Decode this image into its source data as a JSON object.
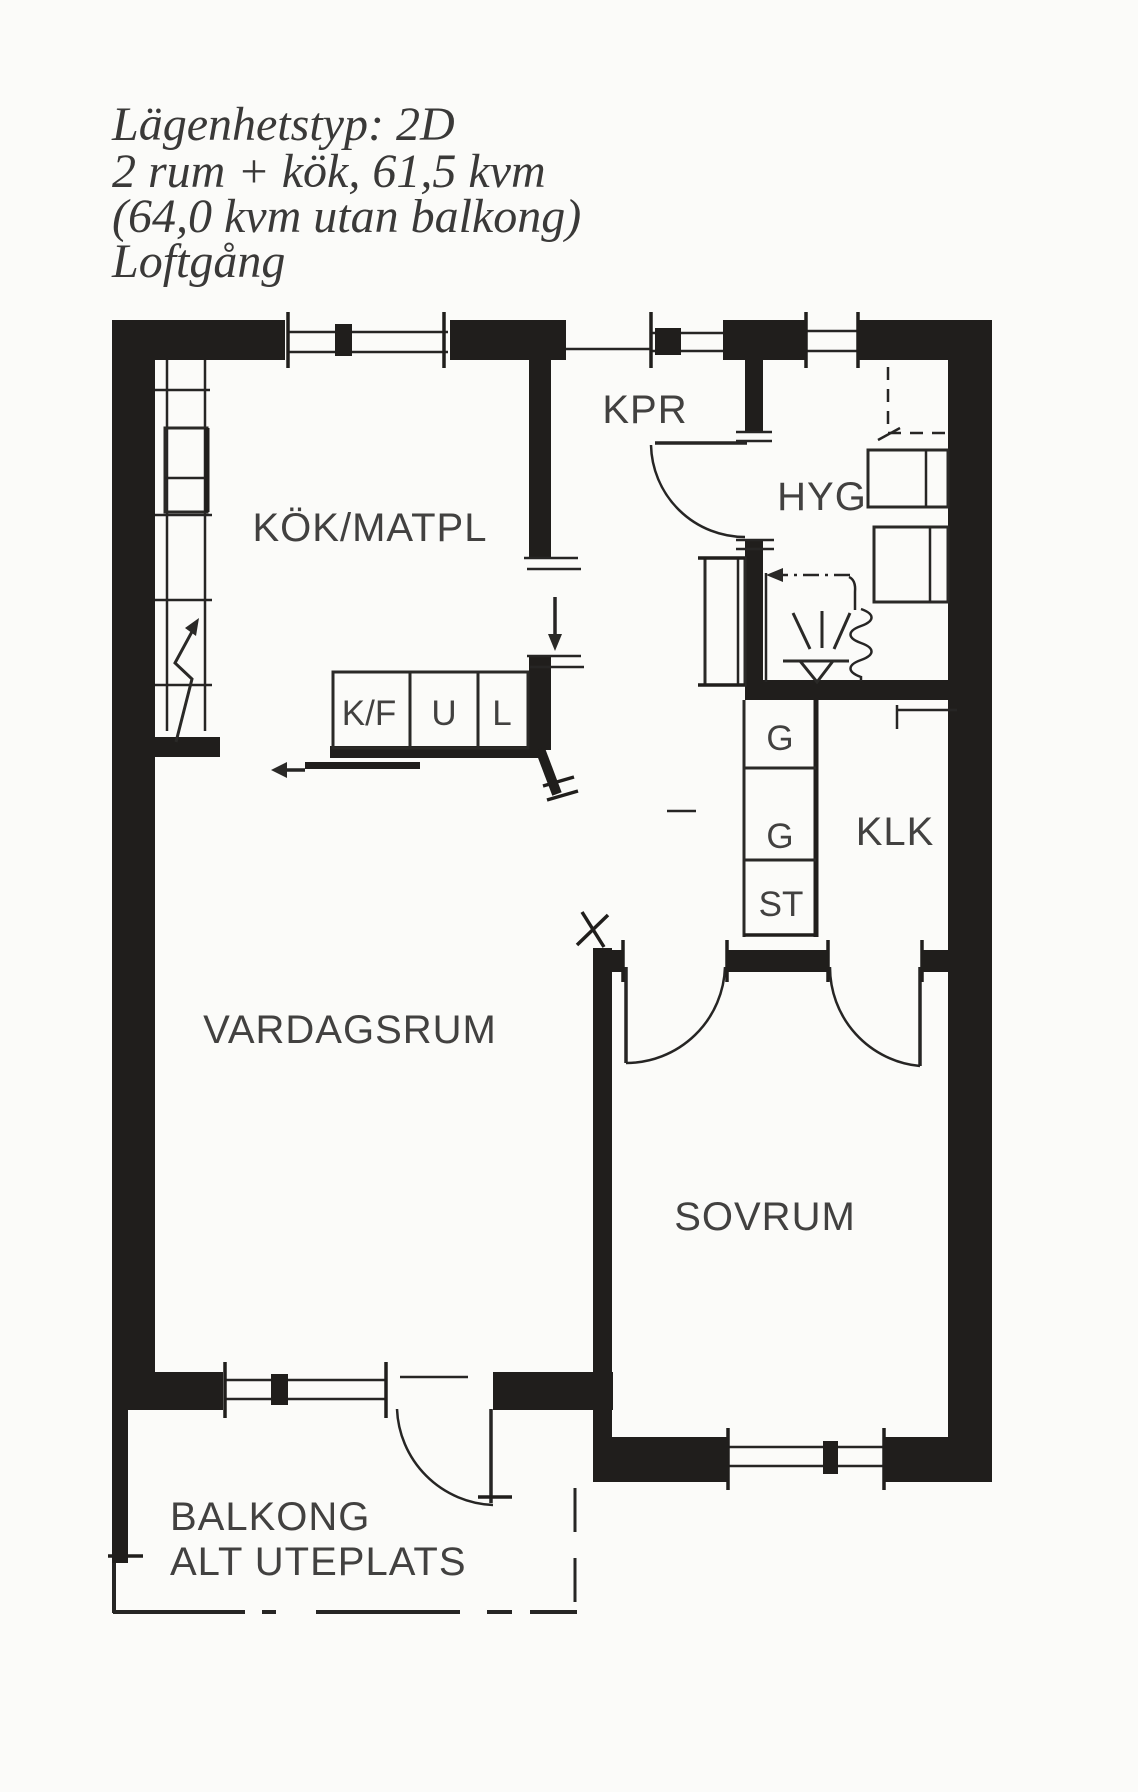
{
  "header": {
    "lines": [
      "Lägenhetstyp: 2D",
      "2 rum + kök, 61,5 kvm",
      "(64,0 kvm utan balkong)",
      "Loftgång"
    ]
  },
  "labels": {
    "rooms": {
      "kitchen": "KÖK/MATPL",
      "entry": "KPR",
      "bathroom": "HYG",
      "walk_in_closet": "KLK",
      "living_room": "VARDAGSRUM",
      "bedroom": "SOVRUM",
      "balcony_line1": "BALKONG",
      "balcony_line2": "ALT UTEPLATS"
    },
    "fixtures": {
      "fridge_freezer": "K/F",
      "oven": "U",
      "cabinet": "L",
      "wardrobe_1": "G",
      "wardrobe_2": "G",
      "storage": "ST"
    }
  },
  "colors": {
    "background": "#fbfbf9",
    "wall": "#201e1c",
    "line": "#2a2927",
    "text": "#424140"
  }
}
